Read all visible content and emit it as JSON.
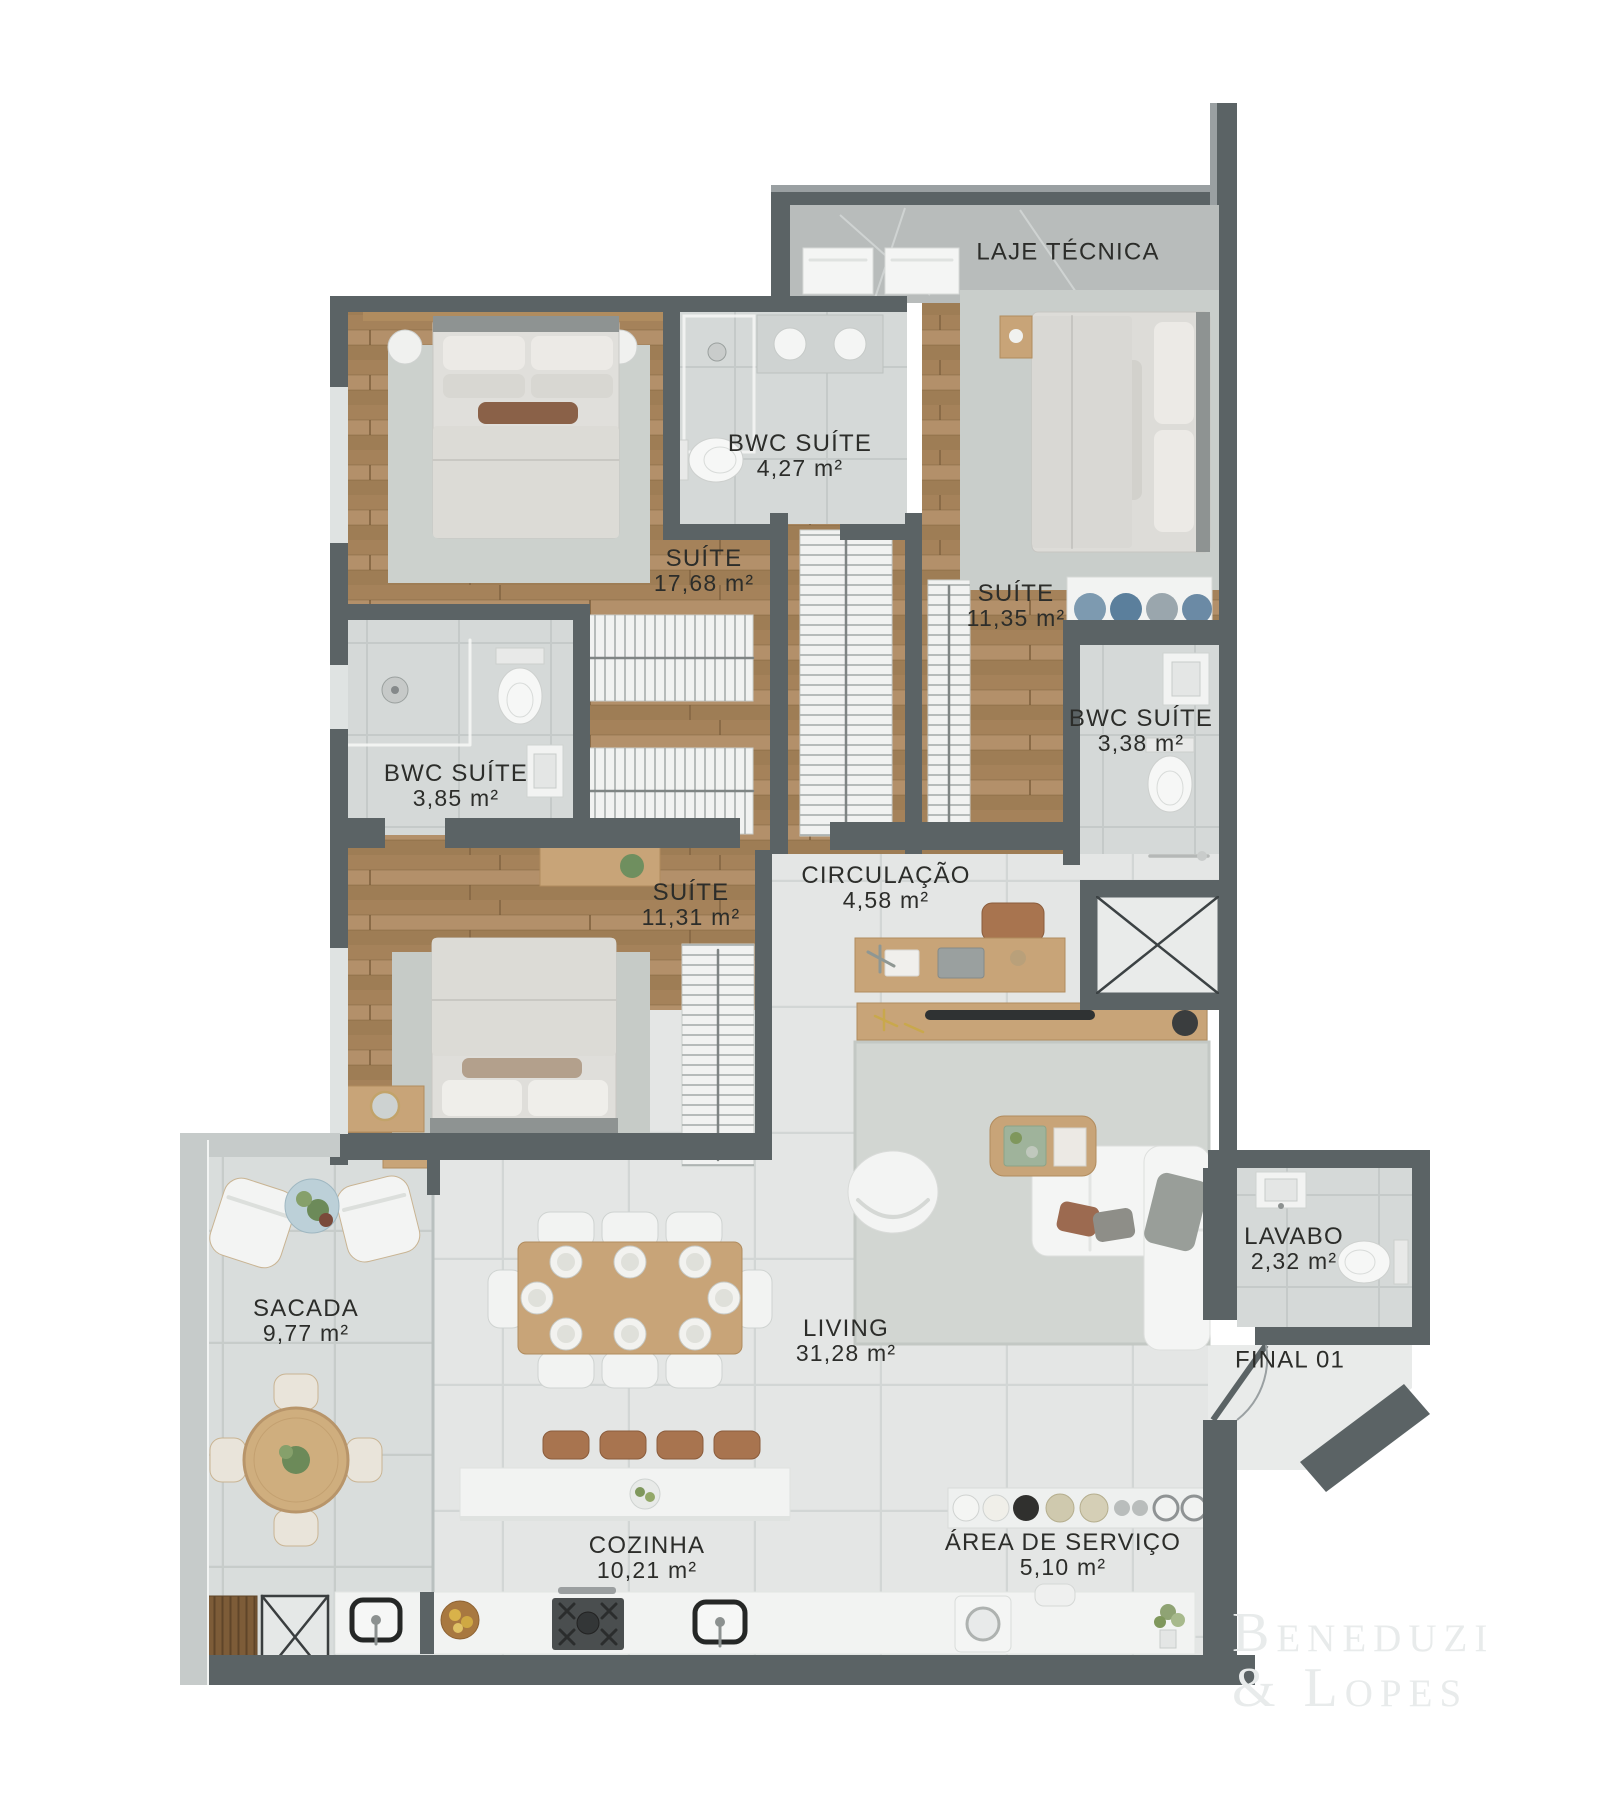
{
  "watermark": {
    "line1": "Beneduzi",
    "line2": "& Lopes"
  },
  "rooms": [
    {
      "id": "laje-tecnica",
      "name": "LAJE TÉCNICA",
      "area": ""
    },
    {
      "id": "bwc-suite-1",
      "name": "BWC SUÍTE",
      "area": "4,27 m²"
    },
    {
      "id": "suite-1",
      "name": "SUÍTE",
      "area": "17,68 m²"
    },
    {
      "id": "suite-2",
      "name": "SUÍTE",
      "area": "11,35 m²"
    },
    {
      "id": "bwc-suite-2",
      "name": "BWC SUÍTE",
      "area": "3,38 m²"
    },
    {
      "id": "bwc-suite-3",
      "name": "BWC SUÍTE",
      "area": "3,85 m²"
    },
    {
      "id": "suite-3",
      "name": "SUÍTE",
      "area": "11,31 m²"
    },
    {
      "id": "circulacao",
      "name": "CIRCULAÇÃO",
      "area": "4,58 m²"
    },
    {
      "id": "lavabo",
      "name": "LAVABO",
      "area": "2,32 m²"
    },
    {
      "id": "sacada",
      "name": "SACADA",
      "area": "9,77 m²"
    },
    {
      "id": "living",
      "name": "LIVING",
      "area": "31,28 m²"
    },
    {
      "id": "cozinha",
      "name": "COZINHA",
      "area": "10,21 m²"
    },
    {
      "id": "area-servico",
      "name": "ÁREA DE SERVIÇO",
      "area": "5,10 m²"
    },
    {
      "id": "final-01",
      "name": "FINAL 01",
      "area": ""
    }
  ],
  "colors": {
    "wall": "#5b6365",
    "wall_top_edge": "#9aa0a2",
    "parapet": "#c6cbca",
    "wood_floor": "#a9875e",
    "tile_living": "#e4e6e5",
    "tile_balcony": "#d9dddc",
    "tile_bath": "#d5d9d8",
    "concrete": "#b8bcbb",
    "rug": "#ccd1cd",
    "white_furniture": "#f4f5f4",
    "leather": "#a8744f",
    "label_text": "#2c2d2a",
    "watermark": "#e8ebeb"
  }
}
